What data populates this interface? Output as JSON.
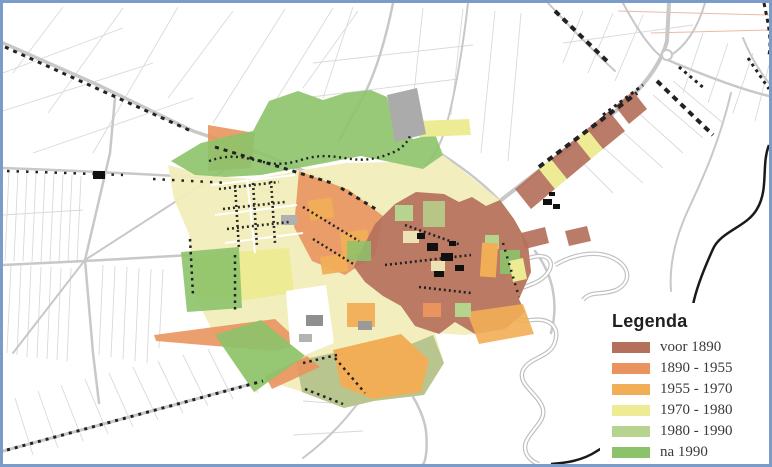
{
  "map": {
    "kind": "building-age-town-map",
    "frame_color": "#7b9cc9"
  },
  "legend": {
    "title": "Legenda",
    "items": [
      {
        "label": "voor 1890",
        "color": "#b5705c"
      },
      {
        "label": "1890 - 1955",
        "color": "#e9945e"
      },
      {
        "label": "1955 - 1970",
        "color": "#f2ae57"
      },
      {
        "label": "1970 - 1980",
        "color": "#eeeb95"
      },
      {
        "label": "1980 - 1990",
        "color": "#b6d48d"
      },
      {
        "label": "na 1990",
        "color": "#8cc36a"
      }
    ]
  },
  "colors": {
    "frame": "#7b9cc9",
    "parcel": "#d9d9d9",
    "road": "#c8c8c8",
    "river": "#bfbfbf",
    "boundary": "#1a1a1a",
    "building": "#222222",
    "grayblock": "#ababab",
    "townbase": "#f2edbb",
    "olive": "#b3c08a",
    "contour": "#e4a98c",
    "pre1890": "#b5705c",
    "p1890": "#e9945e",
    "p1955": "#f2ae57",
    "p1970": "#eeeb95",
    "p1980": "#b6d48d",
    "na1990": "#8cc36a"
  }
}
